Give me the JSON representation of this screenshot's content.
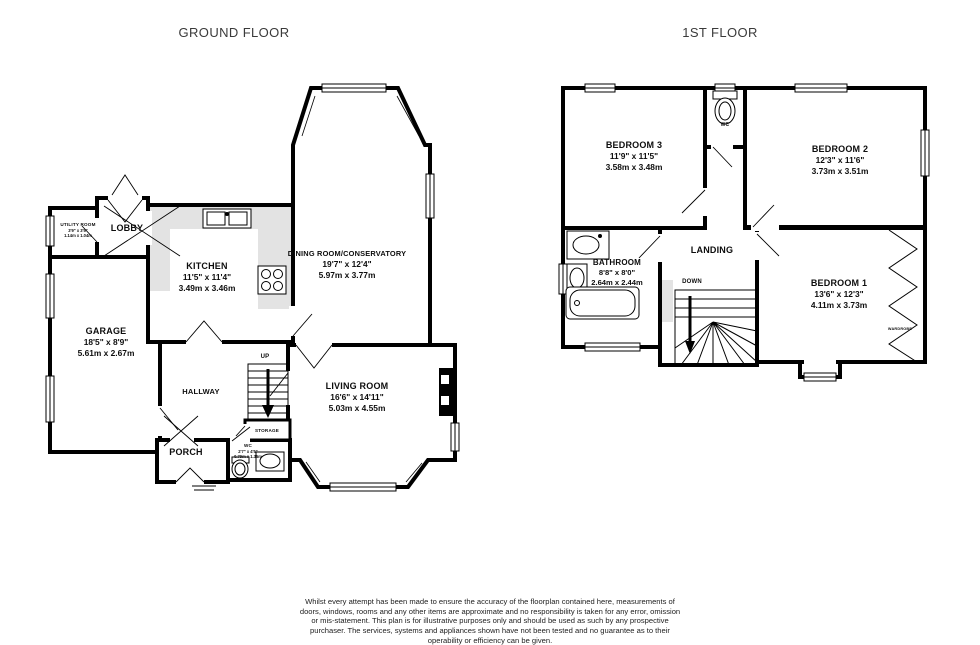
{
  "titles": {
    "ground": "GROUND FLOOR",
    "first": "1ST FLOOR"
  },
  "ground_floor": {
    "lobby": {
      "name": "LOBBY"
    },
    "utility": {
      "name": "UTILITY ROOM",
      "imperial": "3'9\" x 3'5\"",
      "metric": "1.14m x 1.04m"
    },
    "kitchen": {
      "name": "KITCHEN",
      "imperial": "11'5\" x 11'4\"",
      "metric": "3.49m x 3.46m"
    },
    "dining_room": {
      "name": "DINING ROOM/CONSERVATORY",
      "imperial": "19'7\" x 12'4\"",
      "metric": "5.97m x 3.77m"
    },
    "garage": {
      "name": "GARAGE",
      "imperial": "18'5\" x 8'9\"",
      "metric": "5.61m x 2.67m"
    },
    "hallway": {
      "name": "HALLWAY"
    },
    "living_room": {
      "name": "LIVING ROOM",
      "imperial": "16'6\" x 14'11\"",
      "metric": "5.03m x 4.55m"
    },
    "porch": {
      "name": "PORCH"
    },
    "storage": {
      "name": "STORAGE"
    },
    "wc": {
      "name": "WC",
      "imperial": "2'7\" x 4'5\"",
      "metric": "0.79m x 1.35m"
    },
    "stairs": {
      "label": "UP"
    }
  },
  "first_floor": {
    "bedroom_1": {
      "name": "BEDROOM 1",
      "imperial": "13'6\" x 12'3\"",
      "metric": "4.11m x 3.73m"
    },
    "bedroom_2": {
      "name": "BEDROOM 2",
      "imperial": "12'3\" x 11'6\"",
      "metric": "3.73m x 3.51m"
    },
    "bedroom_3": {
      "name": "BEDROOM 3",
      "imperial": "11'9\" x 11'5\"",
      "metric": "3.58m x 3.48m"
    },
    "bathroom": {
      "name": "BATHROOM",
      "imperial": "8'8\" x 8'0\"",
      "metric": "2.64m x 2.44m"
    },
    "landing": {
      "name": "LANDING"
    },
    "wc": {
      "name": "WC"
    },
    "wardrobe": {
      "name": "WARDROBE"
    },
    "stairs": {
      "label": "DOWN"
    }
  },
  "footer": {
    "disclaimer": "Whilst every attempt has been made to ensure the accuracy of the floorplan contained here, measurements of doors, windows, rooms and any other items are approximate and no responsibility is taken for any error, omission or mis-statement. This plan is for illustrative purposes only and should be used as such by any prospective purchaser. The services, systems and appliances shown have not been tested and no guarantee as to their operability or efficiency can be given.",
    "credit": "Made with Metropix ©2026"
  }
}
